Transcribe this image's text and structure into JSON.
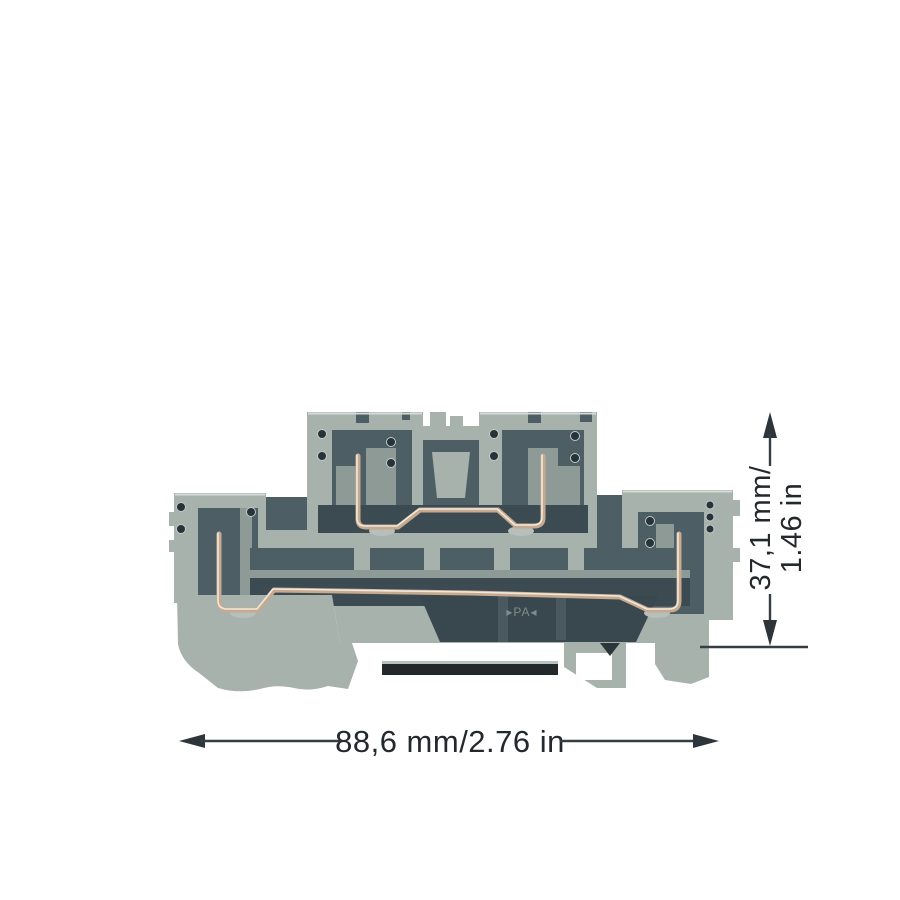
{
  "type": "product-dimension-diagram",
  "background_color": "#ffffff",
  "product": {
    "name": "Double-deck DIN-rail terminal block (side profile)",
    "marking": "▸PA◂",
    "colors": {
      "housing_gray": "#a8b2ad",
      "housing_light": "#cdd3cf",
      "housing_mid": "#8e9a96",
      "recess_slate": "#4d5e64",
      "recess_dark": "#3c4b52",
      "port_hole": "#27333a",
      "clamp_wire_copper": "#c7a98f",
      "din_rail_bar": "#23282a"
    }
  },
  "dimensions": {
    "width": {
      "label": "88,6 mm/2.76 in"
    },
    "height": {
      "label_line1": "37,1 mm/",
      "label_line2": "1.46 in"
    },
    "line_color": "#373e43",
    "text_color": "#23282c"
  }
}
